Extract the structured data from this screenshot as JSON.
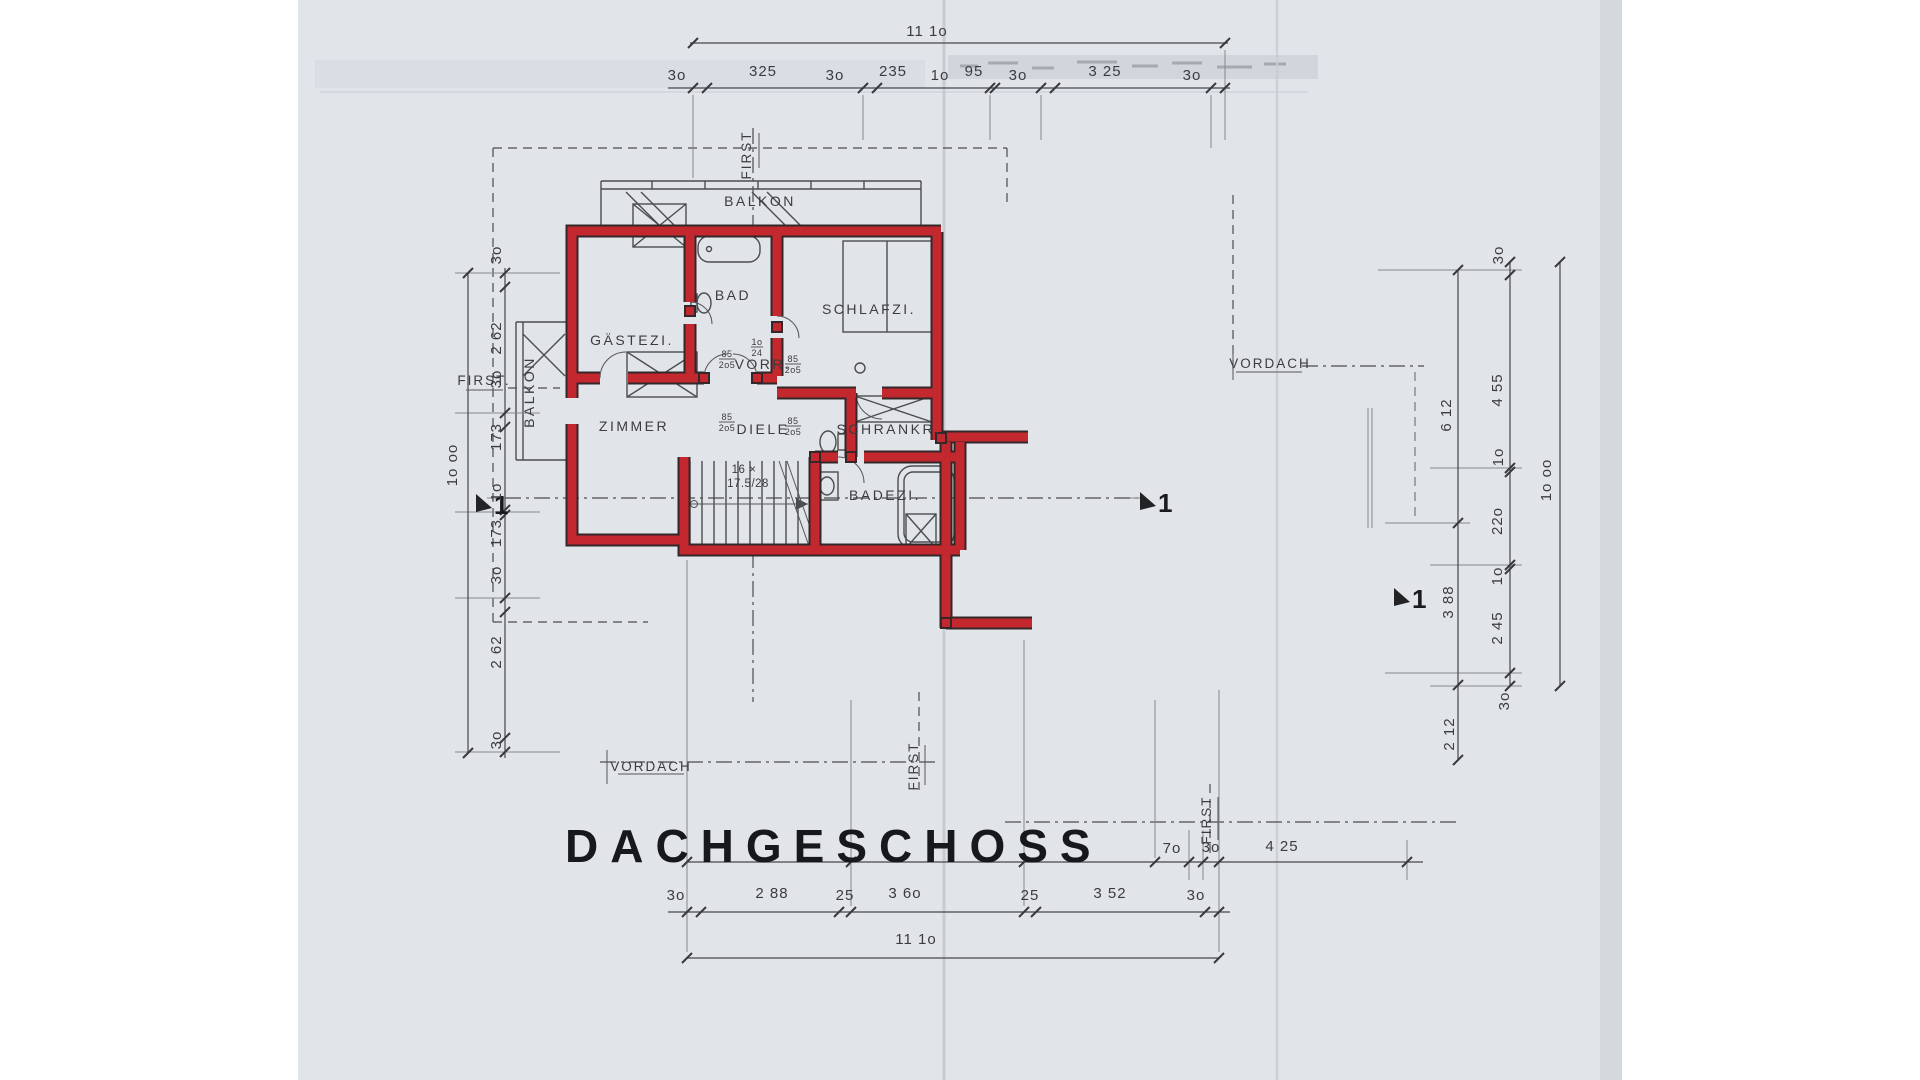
{
  "page": {
    "title": "DACHGESCHOSS"
  },
  "rooms": {
    "balkon_top": "BALKON",
    "gaestezi": "GÄSTEZI.",
    "bad": "BAD",
    "schlafzi": "SCHLAFZI.",
    "vorr": "VORR.",
    "zimmer": "ZIMMER",
    "diele": "DIELE",
    "schrankr": "SCHRANKR.",
    "badezi": "BADEZI.",
    "balkon_left": "BALKON"
  },
  "stair": {
    "line1": "16 ×",
    "line2": "17.5/28"
  },
  "door_tag": {
    "top": "85",
    "bottom": "2o5"
  },
  "door_tag_small": {
    "top": "1o",
    "bottom": "24"
  },
  "ridge": {
    "first_top": "FIRST",
    "first_left": "FIRST.",
    "first_bottom": "FIRST",
    "first_bottom_right": "FIRST"
  },
  "vordach": {
    "right": "VORDACH",
    "bottom": "VORDACH"
  },
  "section": {
    "label": "1"
  },
  "dims": {
    "top": {
      "total": "11 1o",
      "segments": [
        "3o",
        "325",
        "3o",
        "235",
        "1o",
        "95",
        "3o",
        "3 25",
        "3o"
      ]
    },
    "bottom": {
      "total": "11 1o",
      "segments": [
        "3o",
        "2 88",
        "25",
        "3 6o",
        "25",
        "3 52",
        "3o"
      ],
      "right_segments": [
        "7o",
        "3o",
        "4 25"
      ]
    },
    "left": {
      "total": "1o oo",
      "segments": [
        "3o",
        "2 62",
        "3o",
        "173",
        "1o",
        "173",
        "3o",
        "2 62",
        "3o"
      ]
    },
    "right": {
      "total": "1o oo",
      "segments": [
        "3o",
        "4 55",
        "1o",
        "22o",
        "1o",
        "2 45",
        "3o"
      ],
      "inner": [
        "6 12",
        "3 88",
        "2 12"
      ]
    }
  },
  "colors": {
    "wall_red": "#c2282e",
    "ink": "#46474a",
    "paper": "#e1e4e8"
  }
}
